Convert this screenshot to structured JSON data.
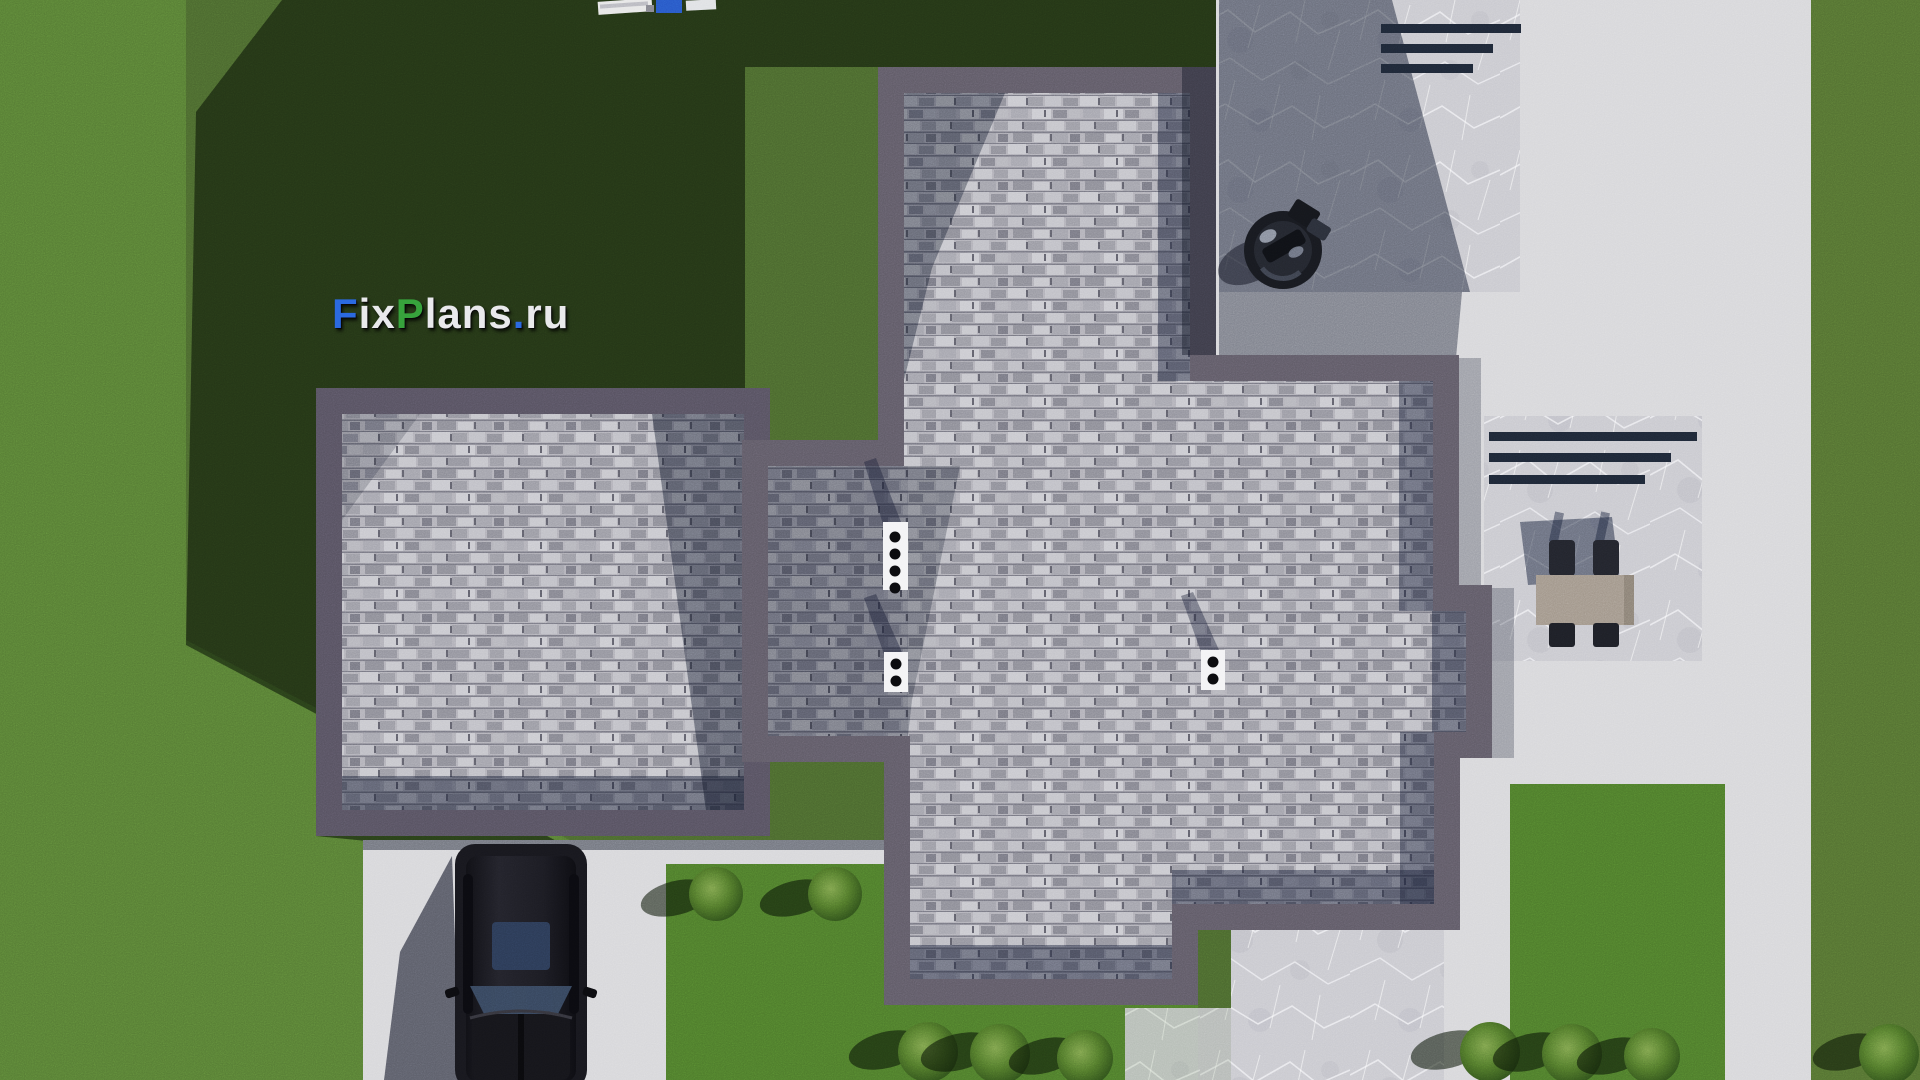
{
  "watermark": {
    "segments": [
      {
        "text": "F",
        "color": "#2b6ae0"
      },
      {
        "text": "ix",
        "color": "#e9e9ec"
      },
      {
        "text": "P",
        "color": "#37a33c"
      },
      {
        "text": "lans",
        "color": "#e9e9ec"
      },
      {
        "text": ".",
        "color": "#2b6ae0"
      },
      {
        "text": "ru",
        "color": "#e9e9ec"
      }
    ]
  },
  "scene": {
    "view": "aerial-top-down-3d-render",
    "objects": [
      "flat-roof-house-with-shingle-roof",
      "black-suv-on-driveway",
      "barbecue-grill-on-upper-patio",
      "dining-table-with-four-chairs",
      "three-white-roof-vents",
      "garden-bushes",
      "lawn",
      "concrete-paths",
      "marble-patios"
    ],
    "vent_dot_counts": [
      4,
      2,
      2
    ]
  },
  "palette": {
    "grass_base": "#4a672e",
    "grass_sunlit": "#567c34",
    "grass_bright": "#4d7a2b",
    "grass_right": "#537031",
    "concrete": "#d7d7da",
    "marble": "#c9c9cf",
    "parapet": "#5f5a66",
    "parapet_wing": "#565160",
    "shingle_base": "#b1b0b8",
    "stair_bar": "#1e2736",
    "vent_white": "#f3f3f5",
    "car_body": "#17171d",
    "car_sunroof": "#2b3a55",
    "table_top": "#a1968a",
    "chair_dark": "#22242c",
    "grill_dark": "#17191f"
  }
}
